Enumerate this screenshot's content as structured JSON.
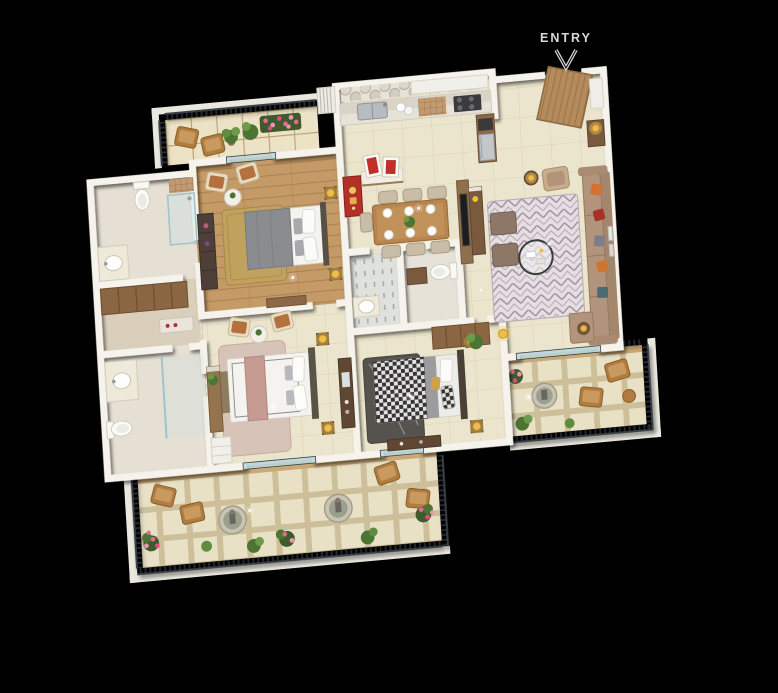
{
  "scene": {
    "description": "3D isometric apartment floor plan render on black background",
    "entry_label": "ENTRY"
  },
  "rooms": {
    "balcony_top": "balcony",
    "bedroom2": "bedroom with grey bed",
    "bath1": "bathroom with shower",
    "dressing": "dressing area with wardrobes",
    "bath2": "bathroom with vanity",
    "master_bedroom": "master bedroom with pink-throw bed",
    "bedroom3": "bedroom with patterned bed",
    "bath3": "common bathroom",
    "kitchen": "kitchen with counter and sink",
    "foyer": "entry foyer",
    "puja": "puja corner with red artwork",
    "dining": "dining area with six chairs",
    "living": "living room with sofa and rug",
    "balcony_bottom": "long balcony with planters",
    "balcony_right": "living room balcony"
  },
  "furniture": {
    "beds": [
      "grey double bed",
      "white bed with pink throw",
      "black-white patterned bed"
    ],
    "seating": [
      "beige L-sofa with orange cushions",
      "two ottomans",
      "balcony lounge chairs",
      "bedroom armchairs"
    ],
    "tables": [
      "round glass coffee table",
      "wood dining table with six plates",
      "round side tables"
    ],
    "fixtures": [
      "toilets",
      "oval basins",
      "glass shower",
      "steel kitchen sink",
      "hob",
      "fridge"
    ],
    "decor": [
      "gold table lamps",
      "red Ganesha panel",
      "framed red artworks",
      "potted plants",
      "pink flower bushes",
      "round stone planters"
    ]
  },
  "colors": {
    "bg": "#000000",
    "wall": "#f6f3ec",
    "floor": "#ece5cd",
    "wood_floor": "#c49a66",
    "balc_tile": "#e6ddbf",
    "rail": "#262b30",
    "rail_top": "#3a4046",
    "glass": "#b9d6da",
    "bed_grey": "#8b8c90",
    "white_bed": "#f4f3ef",
    "pink": "#c59b92",
    "sofa": "#b2937c",
    "orange": "#d4722f",
    "red_cushion": "#a93226",
    "rug_master": "#d8c3b9",
    "wood_dark": "#5f4733",
    "wood_mid": "#8a6642",
    "dining": "#b9854e",
    "gold": "#eebe4d",
    "art_red": "#b23227",
    "green": "#4c7433",
    "green_light": "#6b9a4a",
    "pink_flower": "#e06a93",
    "chair_brown": "#b07c3f",
    "counter": "#d9d4c9",
    "steel": "#b7bcc0",
    "label": "#d8d8d8"
  }
}
